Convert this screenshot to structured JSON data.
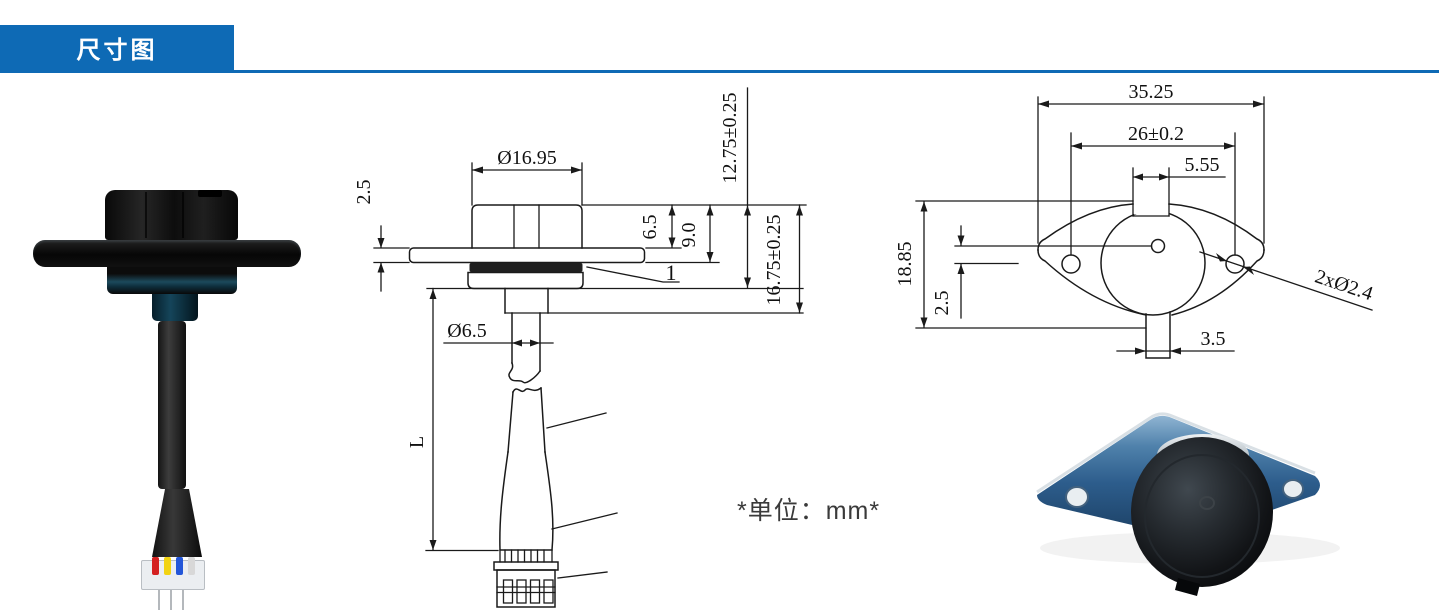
{
  "header": {
    "title": "尺寸图"
  },
  "note": {
    "units": "*单位：mm*"
  },
  "side_view": {
    "cap_diameter": "Ø16.95",
    "flange_thickness": "2.5",
    "hex_height": "6.5",
    "flange_depth": "9.0",
    "body_depth": "12.75±0.25",
    "overall_depth": "16.75±0.25",
    "gasket_item": "1",
    "cable_diameter": "Ø6.5",
    "cable_length": "L"
  },
  "top_view": {
    "overall_width": "35.25",
    "hole_spacing": "26±0.2",
    "notch_width": "5.55",
    "overall_height": "18.85",
    "center_offset": "2.5",
    "tab_width": "3.5",
    "mount_holes": "2xØ2.4"
  },
  "colors": {
    "accent": "#0e6ab5",
    "line_color": "#1a1a1a"
  }
}
